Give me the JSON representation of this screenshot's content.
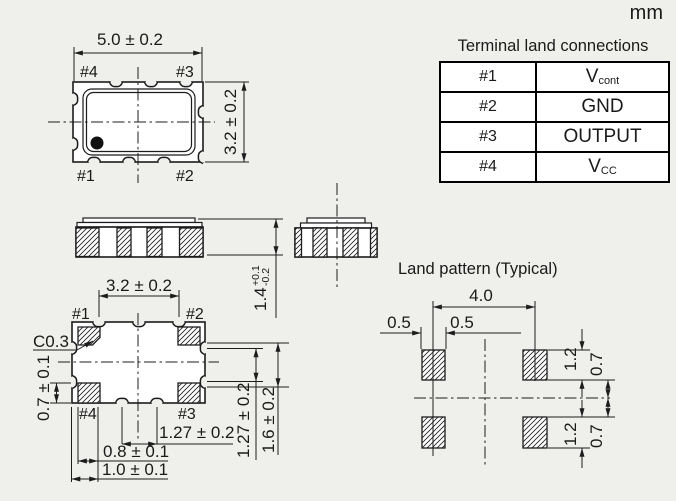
{
  "unit_label": "mm",
  "terminal_table": {
    "title": "Terminal land connections",
    "rows": [
      {
        "terminal": "#1",
        "main": "V",
        "sub": "cont"
      },
      {
        "terminal": "#2",
        "main": "GND",
        "sub": ""
      },
      {
        "terminal": "#3",
        "main": "OUTPUT",
        "sub": ""
      },
      {
        "terminal": "#4",
        "main": "V",
        "sub": "CC"
      }
    ]
  },
  "top_view": {
    "dim_width": "5.0 ± 0.2",
    "dim_height": "3.2 ± 0.2",
    "pin_top_left": "#4",
    "pin_top_right": "#3",
    "pin_bottom_left": "#1",
    "pin_bottom_right": "#2"
  },
  "front_view": {
    "dim_height_main": "1.4",
    "dim_height_tol_plus": "+0.1",
    "dim_height_tol_minus": "-0.2"
  },
  "bottom_view": {
    "dim_width": "3.2 ± 0.2",
    "chamfer_label": "C0.3",
    "dim_pad_height": "0.7 ± 0.1",
    "pin_top_left": "#1",
    "pin_top_right": "#2",
    "pin_bottom_left": "#4",
    "pin_bottom_right": "#3",
    "dim_pitch_bottom": "1.27 ± 0.2",
    "dim_pad_width": "0.8 ± 0.1",
    "dim_corner_pad": "1.0 ± 0.1",
    "dim_pitch_right": "1.27 ± 0.2",
    "dim_edge_right": "1.6 ± 0.2"
  },
  "land_pattern": {
    "title": "Land pattern (Typical)",
    "dim_pitch": "4.0",
    "dim_half_left": "0.5",
    "dim_half_right": "0.5",
    "dim_pad_height_top": "1.2",
    "dim_gap_top": "0.7",
    "dim_pad_height_bottom": "1.2",
    "dim_gap_bottom": "0.7"
  },
  "colors": {
    "background": "#efefec",
    "line": "#1c1c1c",
    "panel": "#ffffff"
  }
}
